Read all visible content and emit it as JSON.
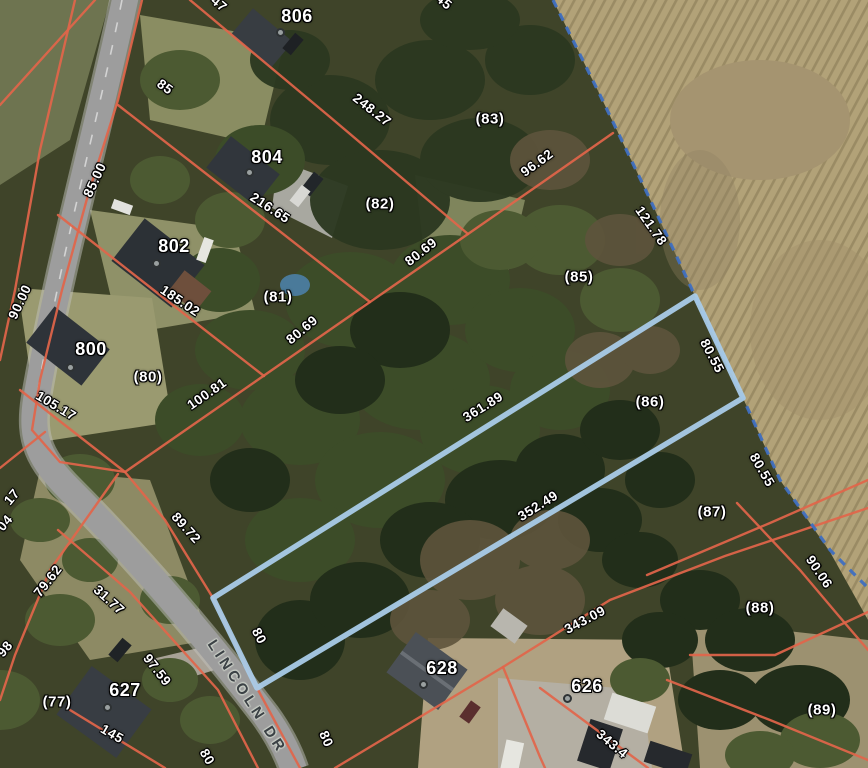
{
  "map": {
    "street_name": "LINCOLN DR",
    "colors": {
      "parcel_line": "#e2654a",
      "boundary_line": "#3f6fc0",
      "selected_parcel_outline": "#a9cbe8",
      "label_text": "#ffffff",
      "road_label_text": "#3b4145",
      "field": "#b2a278",
      "woods": "#3f4429",
      "road_surface": "#9d9d9d"
    },
    "selected_parcel": {
      "id": "(86)",
      "frontage": "80",
      "side_a": "361.89",
      "side_b": "352.49",
      "rear": "80.55"
    },
    "labels": [
      {
        "kind": "address",
        "text": "806",
        "x": 297,
        "y": 16,
        "rot": 0
      },
      {
        "kind": "address",
        "text": "804",
        "x": 267,
        "y": 157,
        "rot": 0
      },
      {
        "kind": "address",
        "text": "802",
        "x": 174,
        "y": 246,
        "rot": 0
      },
      {
        "kind": "address",
        "text": "800",
        "x": 91,
        "y": 349,
        "rot": 0
      },
      {
        "kind": "address",
        "text": "627",
        "x": 125,
        "y": 690,
        "rot": 0
      },
      {
        "kind": "address",
        "text": "628",
        "x": 442,
        "y": 668,
        "rot": 0
      },
      {
        "kind": "address",
        "text": "626",
        "x": 587,
        "y": 686,
        "rot": 0
      },
      {
        "kind": "parcel",
        "text": "(83)",
        "x": 490,
        "y": 119,
        "rot": 0
      },
      {
        "kind": "parcel",
        "text": "(82)",
        "x": 380,
        "y": 204,
        "rot": 0
      },
      {
        "kind": "parcel",
        "text": "(81)",
        "x": 278,
        "y": 297,
        "rot": 0
      },
      {
        "kind": "parcel",
        "text": "(80)",
        "x": 148,
        "y": 377,
        "rot": 0
      },
      {
        "kind": "parcel",
        "text": "(85)",
        "x": 579,
        "y": 277,
        "rot": 0
      },
      {
        "kind": "parcel",
        "text": "(86)",
        "x": 650,
        "y": 402,
        "rot": 0
      },
      {
        "kind": "parcel",
        "text": "(87)",
        "x": 712,
        "y": 512,
        "rot": 0
      },
      {
        "kind": "parcel",
        "text": "(88)",
        "x": 760,
        "y": 608,
        "rot": 0
      },
      {
        "kind": "parcel",
        "text": "(89)",
        "x": 822,
        "y": 710,
        "rot": 0
      },
      {
        "kind": "parcel",
        "text": "(77)",
        "x": 57,
        "y": 702,
        "rot": 0
      },
      {
        "kind": "dimension",
        "text": "248.27",
        "x": 372,
        "y": 110,
        "rot": 38
      },
      {
        "kind": "dimension",
        "text": "216.65",
        "x": 270,
        "y": 208,
        "rot": 33
      },
      {
        "kind": "dimension",
        "text": "185.02",
        "x": 180,
        "y": 301,
        "rot": 34
      },
      {
        "kind": "dimension",
        "text": "96.62",
        "x": 537,
        "y": 163,
        "rot": -36
      },
      {
        "kind": "dimension",
        "text": "121.78",
        "x": 651,
        "y": 226,
        "rot": 55
      },
      {
        "kind": "dimension",
        "text": "80.69",
        "x": 421,
        "y": 252,
        "rot": -38
      },
      {
        "kind": "dimension",
        "text": "80.69",
        "x": 302,
        "y": 330,
        "rot": -40
      },
      {
        "kind": "dimension",
        "text": "100.81",
        "x": 207,
        "y": 394,
        "rot": -35
      },
      {
        "kind": "dimension",
        "text": "105.17",
        "x": 56,
        "y": 406,
        "rot": 31
      },
      {
        "kind": "dimension",
        "text": "85",
        "x": 165,
        "y": 87,
        "rot": 36
      },
      {
        "kind": "dimension",
        "text": "85.00",
        "x": 95,
        "y": 180,
        "rot": -65
      },
      {
        "kind": "dimension",
        "text": "90.00",
        "x": 20,
        "y": 302,
        "rot": -65
      },
      {
        "kind": "dimension",
        "text": "361.89",
        "x": 483,
        "y": 407,
        "rot": -32
      },
      {
        "kind": "dimension",
        "text": "352.49",
        "x": 538,
        "y": 506,
        "rot": -32
      },
      {
        "kind": "dimension",
        "text": "343.09",
        "x": 585,
        "y": 620,
        "rot": -28
      },
      {
        "kind": "dimension",
        "text": "80.55",
        "x": 712,
        "y": 356,
        "rot": 62
      },
      {
        "kind": "dimension",
        "text": "80.55",
        "x": 762,
        "y": 470,
        "rot": 60
      },
      {
        "kind": "dimension",
        "text": "90.06",
        "x": 819,
        "y": 572,
        "rot": 56
      },
      {
        "kind": "dimension",
        "text": "89.72",
        "x": 186,
        "y": 528,
        "rot": 48
      },
      {
        "kind": "dimension",
        "text": "79.62",
        "x": 48,
        "y": 581,
        "rot": -52
      },
      {
        "kind": "dimension",
        "text": "31.77",
        "x": 109,
        "y": 600,
        "rot": 42
      },
      {
        "kind": "dimension",
        "text": "97.59",
        "x": 157,
        "y": 670,
        "rot": 52
      },
      {
        "kind": "dimension",
        "text": "145",
        "x": 112,
        "y": 734,
        "rot": 30
      },
      {
        "kind": "dimension",
        "text": "80",
        "x": 259,
        "y": 636,
        "rot": 62
      },
      {
        "kind": "dimension",
        "text": "80",
        "x": 326,
        "y": 739,
        "rot": 66
      },
      {
        "kind": "dimension",
        "text": "80",
        "x": 207,
        "y": 757,
        "rot": 60
      },
      {
        "kind": "dimension",
        "text": "343.4",
        "x": 612,
        "y": 744,
        "rot": 40
      },
      {
        "kind": "dimension",
        "text": "47",
        "x": 219,
        "y": 4,
        "rot": 40
      },
      {
        "kind": "dimension",
        "text": "45",
        "x": 444,
        "y": 2,
        "rot": 40
      },
      {
        "kind": "dimension",
        "text": "17",
        "x": 12,
        "y": 497,
        "rot": -50
      },
      {
        "kind": "dimension",
        "text": "04",
        "x": 5,
        "y": 523,
        "rot": -50
      },
      {
        "kind": "dimension",
        "text": "98",
        "x": 5,
        "y": 649,
        "rot": -50
      },
      {
        "kind": "road",
        "text": "LINCOLN DR",
        "x": 247,
        "y": 697,
        "rot": 57
      }
    ],
    "markers": [
      {
        "x": 280,
        "y": 32
      },
      {
        "x": 249,
        "y": 172
      },
      {
        "x": 156,
        "y": 263
      },
      {
        "x": 70,
        "y": 367
      },
      {
        "x": 107,
        "y": 707
      },
      {
        "x": 423,
        "y": 684
      },
      {
        "x": 567,
        "y": 698
      }
    ]
  }
}
